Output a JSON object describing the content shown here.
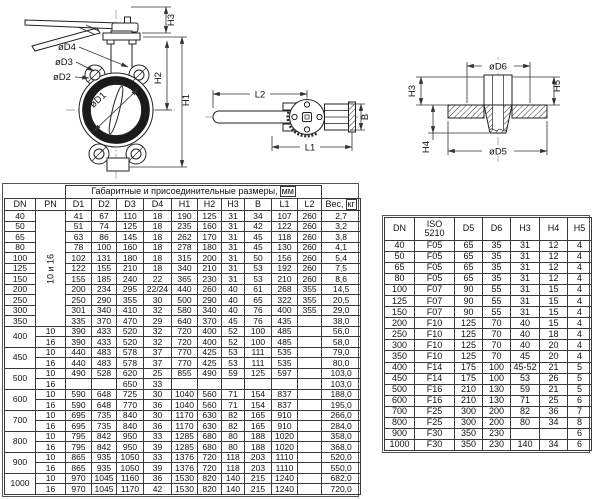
{
  "drawing_labels": {
    "front": {
      "oD4": "øD4",
      "oD3": "øD3",
      "oD2": "øD2",
      "oD1": "øD1",
      "H1": "H1",
      "H2": "H2",
      "H3": "H3"
    },
    "plan": {
      "L1": "L1",
      "L2": "L2",
      "B": "B"
    },
    "section": {
      "oD5": "øD5",
      "oD6": "øD6",
      "H3": "H3",
      "H4": "H4",
      "H5": "H5"
    }
  },
  "table1": {
    "title": "Габаритные и присоединительные размеры,",
    "title_unit": "мм",
    "headers": [
      "DN",
      "PN",
      "D1",
      "D2",
      "D3",
      "D4",
      "H1",
      "H2",
      "H3",
      "B",
      "L1",
      "L2"
    ],
    "weight_header": "Вес,",
    "weight_unit": "кг",
    "rows": [
      [
        "40",
        {
          "t": "10 и 16",
          "rs": 11,
          "v": 1
        },
        "41",
        "67",
        "110",
        "18",
        "190",
        "125",
        "31",
        "34",
        "107",
        "260",
        "2,7"
      ],
      [
        "50",
        "51",
        "74",
        "125",
        "18",
        "235",
        "160",
        "31",
        "42",
        "122",
        "260",
        "3,2"
      ],
      [
        "65",
        "63",
        "86",
        "145",
        "18",
        "262",
        "170",
        "31",
        "45",
        "118",
        "260",
        "3,8"
      ],
      [
        "80",
        "78",
        "100",
        "160",
        "18",
        "278",
        "180",
        "31",
        "45",
        "130",
        "260",
        "4,1"
      ],
      [
        "100",
        "102",
        "131",
        "180",
        "18",
        "315",
        "200",
        "31",
        "50",
        "156",
        "260",
        "5,4"
      ],
      [
        "125",
        "122",
        "155",
        "210",
        "18",
        "340",
        "210",
        "31",
        "53",
        "192",
        "260",
        "7,5"
      ],
      [
        "150",
        "155",
        "185",
        "240",
        "22",
        "365",
        "230",
        "31",
        "53",
        "210",
        "260",
        "8,6"
      ],
      [
        "200",
        "200",
        "234",
        "295",
        "22/24",
        "440",
        "260",
        "40",
        "61",
        "268",
        "355",
        "14,5"
      ],
      [
        "250",
        "250",
        "290",
        "355",
        "30",
        "500",
        "290",
        "40",
        "65",
        "322",
        "355",
        "20,5"
      ],
      [
        "300",
        "301",
        "340",
        "410",
        "32",
        "580",
        "340",
        "40",
        "76",
        "400",
        "355",
        "29,0"
      ],
      [
        "350",
        "335",
        "370",
        "470",
        "29",
        "640",
        "370",
        "45",
        "76",
        "435",
        "",
        "38,0"
      ],
      [
        {
          "t": "400",
          "rs": 2
        },
        "10",
        "390",
        "433",
        "520",
        "32",
        "720",
        "400",
        "52",
        "100",
        "485",
        "",
        "56,0"
      ],
      [
        "16",
        "390",
        "433",
        "520",
        "32",
        "720",
        "400",
        "52",
        "100",
        "485",
        "",
        "58,0"
      ],
      [
        {
          "t": "450",
          "rs": 2
        },
        "10",
        "440",
        "483",
        "578",
        "37",
        "770",
        "425",
        "53",
        "111",
        "535",
        "",
        "79,0"
      ],
      [
        "16",
        "440",
        "483",
        "578",
        "37",
        "770",
        "425",
        "53",
        "111",
        "535",
        "",
        "80,0"
      ],
      [
        {
          "t": "500",
          "rs": 2
        },
        "10",
        "490",
        "528",
        "620",
        "25",
        "855",
        "490",
        "59",
        "125",
        "597",
        "",
        "103,0"
      ],
      [
        "16",
        "",
        "",
        "650",
        "33",
        "",
        "",
        "",
        "",
        "",
        "",
        "103,0"
      ],
      [
        {
          "t": "600",
          "rs": 2
        },
        "10",
        "590",
        "648",
        "725",
        "30",
        "1040",
        "560",
        "71",
        "154",
        "837",
        "",
        "188,0"
      ],
      [
        "16",
        "590",
        "648",
        "770",
        "36",
        "1040",
        "560",
        "71",
        "154",
        "837",
        "",
        "195,0"
      ],
      [
        {
          "t": "700",
          "rs": 2
        },
        "10",
        "695",
        "735",
        "840",
        "30",
        "1170",
        "630",
        "82",
        "165",
        "910",
        "",
        "266,0"
      ],
      [
        "16",
        "695",
        "735",
        "840",
        "36",
        "1170",
        "630",
        "82",
        "165",
        "910",
        "",
        "284,0"
      ],
      [
        {
          "t": "800",
          "rs": 2
        },
        "10",
        "795",
        "842",
        "950",
        "33",
        "1285",
        "680",
        "80",
        "188",
        "1020",
        "",
        "358,0"
      ],
      [
        "16",
        "795",
        "842",
        "950",
        "39",
        "1285",
        "680",
        "80",
        "188",
        "1020",
        "",
        "368,0"
      ],
      [
        {
          "t": "900",
          "rs": 2
        },
        "10",
        "865",
        "935",
        "1050",
        "33",
        "1376",
        "720",
        "118",
        "203",
        "1110",
        "",
        "520,0"
      ],
      [
        "16",
        "865",
        "935",
        "1050",
        "39",
        "1376",
        "720",
        "118",
        "203",
        "1110",
        "",
        "550,0"
      ],
      [
        {
          "t": "1000",
          "rs": 2
        },
        "10",
        "970",
        "1045",
        "1160",
        "36",
        "1530",
        "820",
        "140",
        "215",
        "1240",
        "",
        "682,0"
      ],
      [
        "16",
        "970",
        "1045",
        "1170",
        "42",
        "1530",
        "820",
        "140",
        "215",
        "1240",
        "",
        "720,0"
      ]
    ]
  },
  "table2": {
    "headers": [
      "DN",
      "ISO\n5210",
      "D5",
      "D6",
      "H3",
      "H4",
      "H5"
    ],
    "rows": [
      [
        "40",
        "F05",
        "65",
        "35",
        "31",
        "12",
        "4"
      ],
      [
        "50",
        "F05",
        "65",
        "35",
        "31",
        "12",
        "4"
      ],
      [
        "65",
        "F05",
        "65",
        "35",
        "31",
        "12",
        "4"
      ],
      [
        "80",
        "F05",
        "65",
        "35",
        "31",
        "12",
        "4"
      ],
      [
        "100",
        "F07",
        "90",
        "55",
        "31",
        "15",
        "4"
      ],
      [
        "125",
        "F07",
        "90",
        "55",
        "31",
        "15",
        "4"
      ],
      [
        "150",
        "F07",
        "90",
        "55",
        "31",
        "15",
        "4"
      ],
      [
        "200",
        "F10",
        "125",
        "70",
        "40",
        "15",
        "4"
      ],
      [
        "250",
        "F10",
        "125",
        "70",
        "40",
        "18",
        "4"
      ],
      [
        "300",
        "F10",
        "125",
        "70",
        "40",
        "20",
        "4"
      ],
      [
        "350",
        "F10",
        "125",
        "70",
        "45",
        "20",
        "4"
      ],
      [
        "400",
        "F14",
        "175",
        "100",
        "45-52",
        "21",
        "5"
      ],
      [
        "450",
        "F14",
        "175",
        "100",
        "53",
        "26",
        "5"
      ],
      [
        "500",
        "F16",
        "210",
        "130",
        "59",
        "21",
        "5"
      ],
      [
        "600",
        "F16",
        "210",
        "130",
        "71",
        "25",
        "6"
      ],
      [
        "700",
        "F25",
        "300",
        "200",
        "82",
        "36",
        "7"
      ],
      [
        "800",
        "F25",
        "300",
        "200",
        "80",
        "34",
        "8"
      ],
      [
        "900",
        "F30",
        "350",
        "230",
        "",
        "",
        "6"
      ],
      [
        "1000",
        "F30",
        "350",
        "230",
        "140",
        "34",
        "6"
      ]
    ]
  }
}
